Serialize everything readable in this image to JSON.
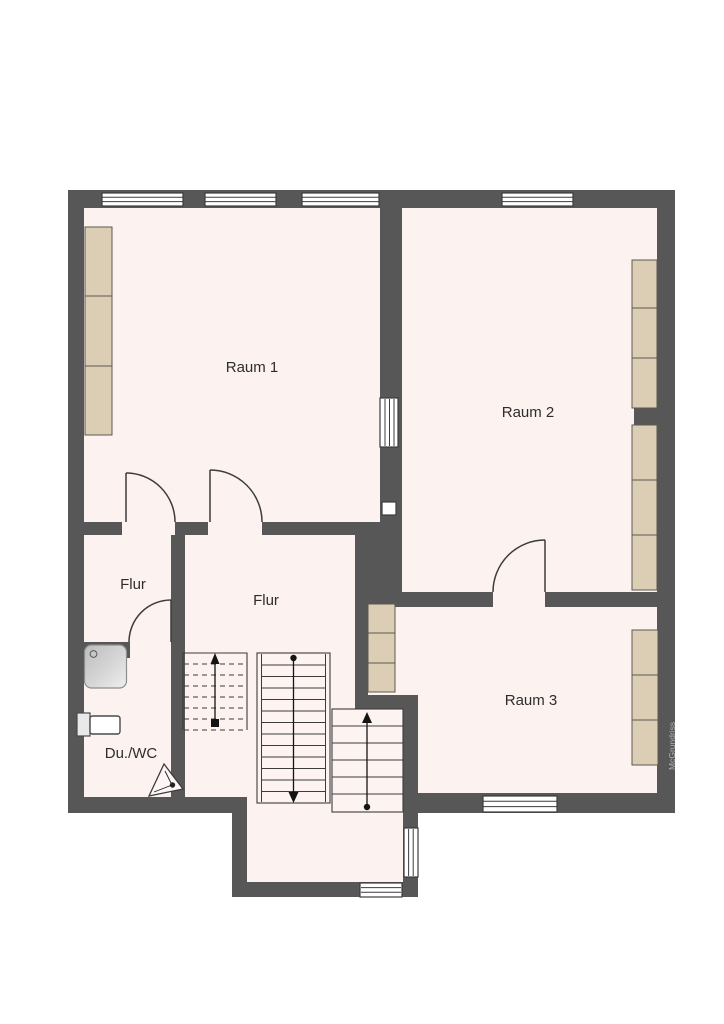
{
  "watermark": "McGrundriss",
  "colors": {
    "wall": "#575757",
    "floor": "#fcf2f0",
    "furniture": "#dbceb5",
    "line": "#3c3c3c",
    "watermark": "#b2b2b2"
  },
  "rooms": [
    {
      "id": "raum-1",
      "label": "Raum 1"
    },
    {
      "id": "raum-2",
      "label": "Raum 2"
    },
    {
      "id": "raum-3",
      "label": "Raum 3"
    },
    {
      "id": "flur-west",
      "label": "Flur"
    },
    {
      "id": "flur-center",
      "label": "Flur"
    },
    {
      "id": "du-wc",
      "label": "Du./WC"
    }
  ],
  "fixtures": {
    "shower": "shower-tray-icon",
    "toilet": "toilet-icon",
    "position_marker": "camera-marker-icon"
  },
  "stairs": {
    "flights": [
      {
        "name": "upper-flight-dashed",
        "direction": "up"
      },
      {
        "name": "main-flight",
        "direction": "down"
      },
      {
        "name": "lower-flight",
        "direction": "up"
      }
    ]
  }
}
